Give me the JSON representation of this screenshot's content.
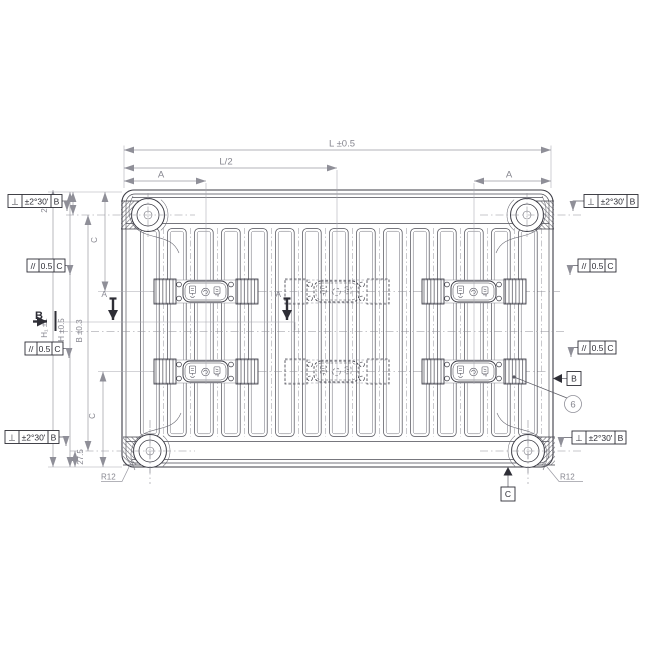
{
  "drawing": {
    "dimensions": {
      "top": {
        "overall_length": "L ±0.5",
        "half_length": "L/2",
        "bracket_offset_left": "A",
        "bracket_offset_right": "A"
      },
      "left": {
        "edge_to_boss_top": "27.5",
        "top_c": "C",
        "height_outer": "H₁ ±1",
        "height": "H ±0.5",
        "hub_distance": "B ±0.3",
        "bottom_c": "C",
        "edge_to_boss_bottom": "27.5"
      },
      "corner_radius_left": "R12",
      "corner_radius_right": "R12"
    },
    "tolerance_frames": {
      "perpendicularity": {
        "symbol": "⊥",
        "tolerance": "±2°30'",
        "datum": "B"
      },
      "parallelism": {
        "symbol": "//",
        "tolerance": "0.5",
        "datum": "C"
      }
    },
    "sections": {
      "a": "A",
      "b": "B"
    },
    "datums": {
      "b": "B",
      "c": "C"
    },
    "balloon": "6",
    "colors": {
      "line": "#3d3d46",
      "dimension": "#9a9aa3",
      "text": "#86868f",
      "frame_text": "#2e2e36"
    }
  }
}
